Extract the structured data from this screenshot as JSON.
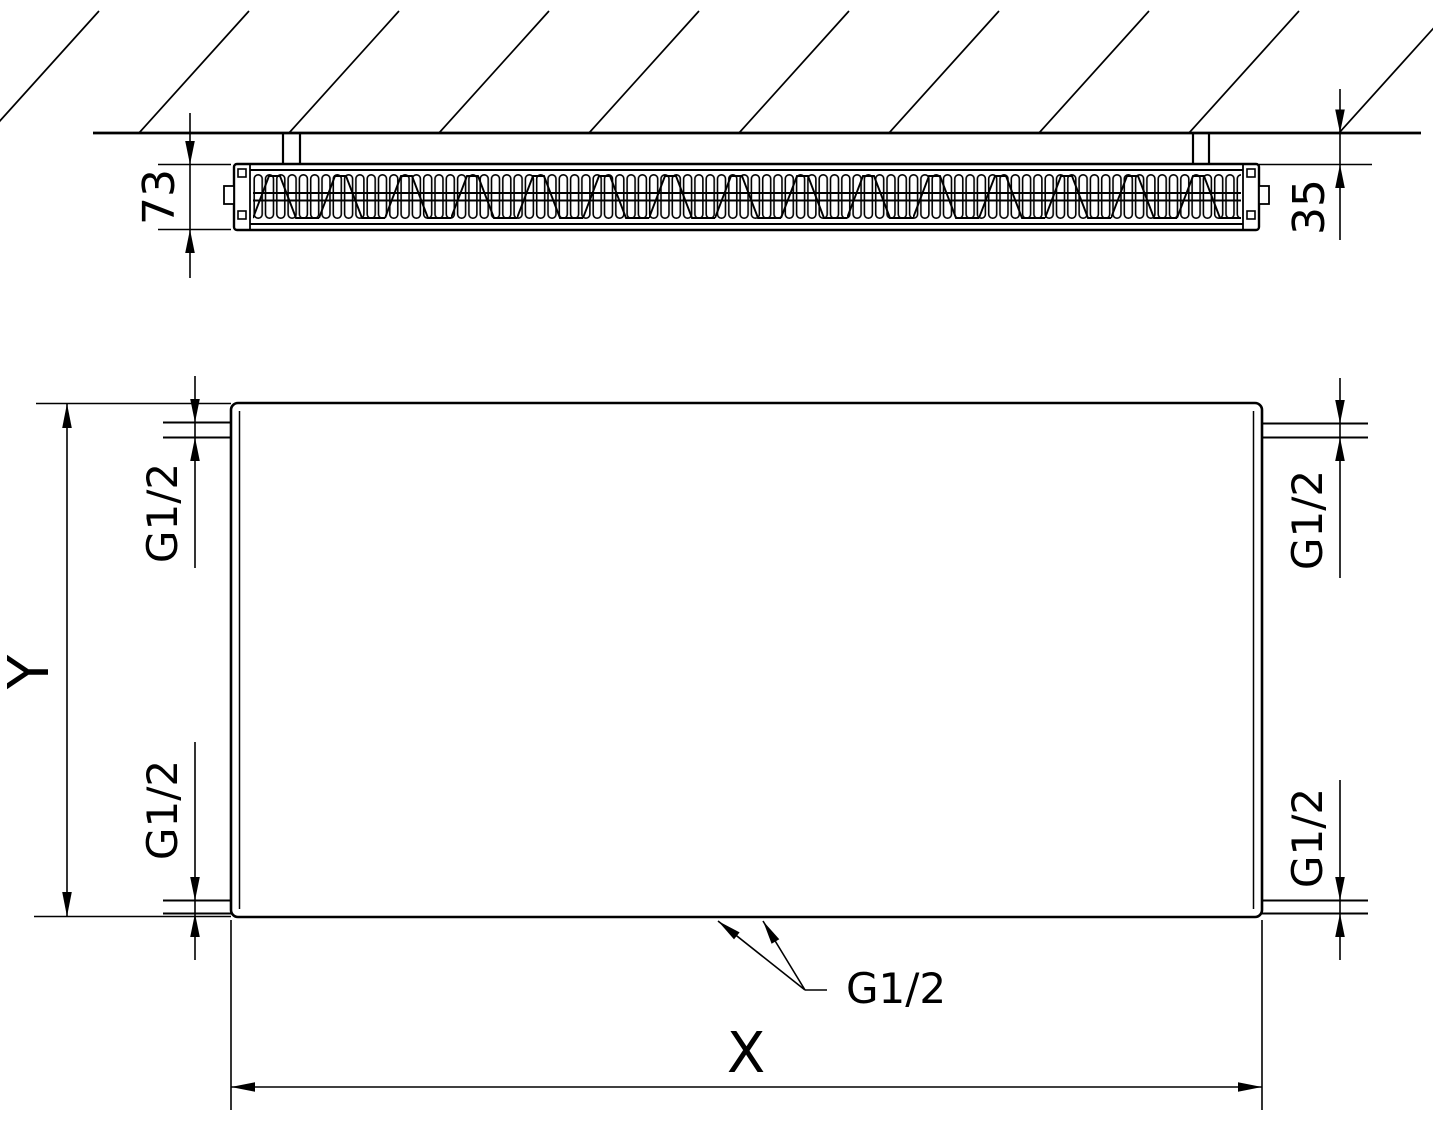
{
  "diagram": {
    "kind": "radiator-technical-drawing",
    "background_color": "#ffffff",
    "line_color": "#000000",
    "top_view": {
      "depth_dimension": "73",
      "wall_distance_dimension": "35"
    },
    "front_view": {
      "height_label": "Y",
      "width_label": "X",
      "connections": {
        "top_left": "G1/2",
        "top_right": "G1/2",
        "bottom_left": "G1/2",
        "bottom_right": "G1/2",
        "bottom_center": "G1/2"
      }
    }
  }
}
